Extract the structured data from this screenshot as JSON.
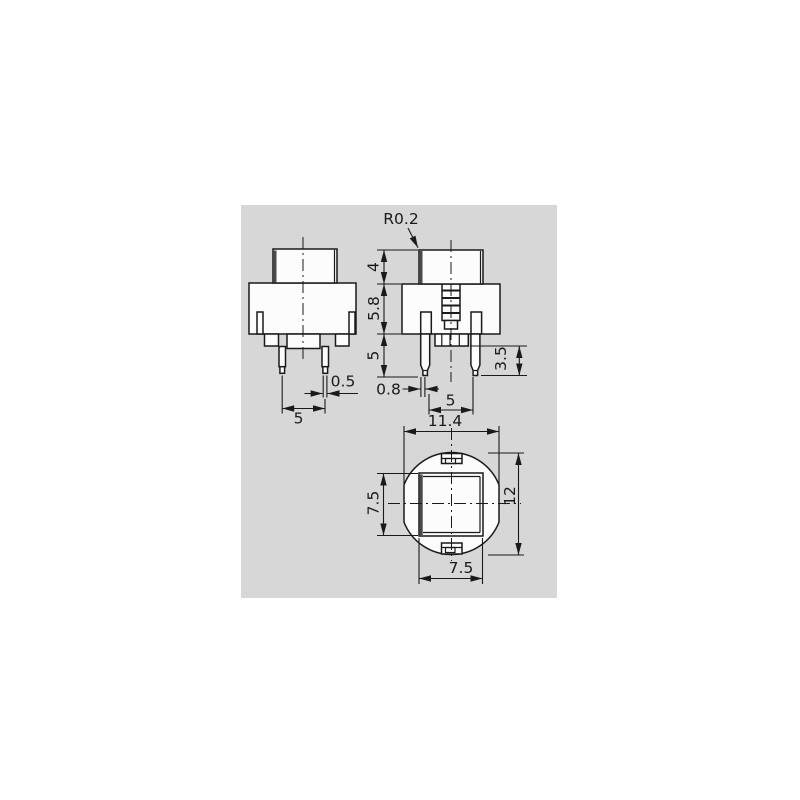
{
  "title": "switch-dimension-drawing",
  "colors": {
    "panel_bg": "#d7d7d7",
    "line": "#1a1a1a",
    "shadow_edge": "#4a4a4a",
    "shape_fill": "#fcfcfc"
  },
  "drawing": {
    "side_view": {
      "pin_width": "0.5",
      "pin_pitch": "5"
    },
    "front_view": {
      "corner_radius": "R0.2",
      "cap_height": "4",
      "body_height": "5.8",
      "pin_length": "5",
      "pin_tip_length": "3.5",
      "pin_width": "0.8",
      "pin_pitch": "5"
    },
    "top_view": {
      "width_across_flats": "11.4",
      "cap_height": "7.5",
      "outer_diameter": "12",
      "cap_width": "7.5"
    }
  }
}
